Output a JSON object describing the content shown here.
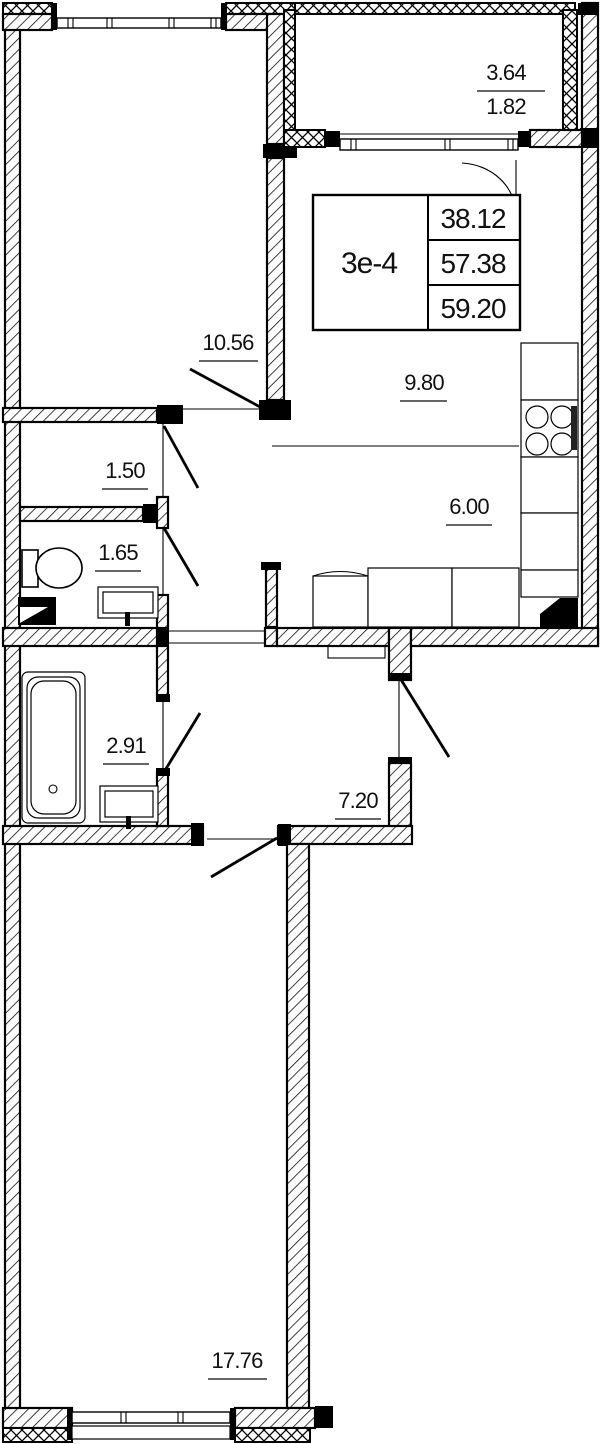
{
  "floorplan": {
    "unit_table": {
      "unit_label": "3e-4",
      "values": [
        "38.12",
        "57.38",
        "59.20"
      ]
    },
    "balcony": {
      "area_full": "3.64",
      "area_reduced": "1.82"
    },
    "rooms": {
      "bedroom_top": "10.56",
      "living_zone": "9.80",
      "kitchen_zone": "6.00",
      "wc_small": "1.50",
      "wc_large": "1.65",
      "bathroom": "2.91",
      "hallway": "7.20",
      "bedroom_bottom": "17.76"
    }
  }
}
